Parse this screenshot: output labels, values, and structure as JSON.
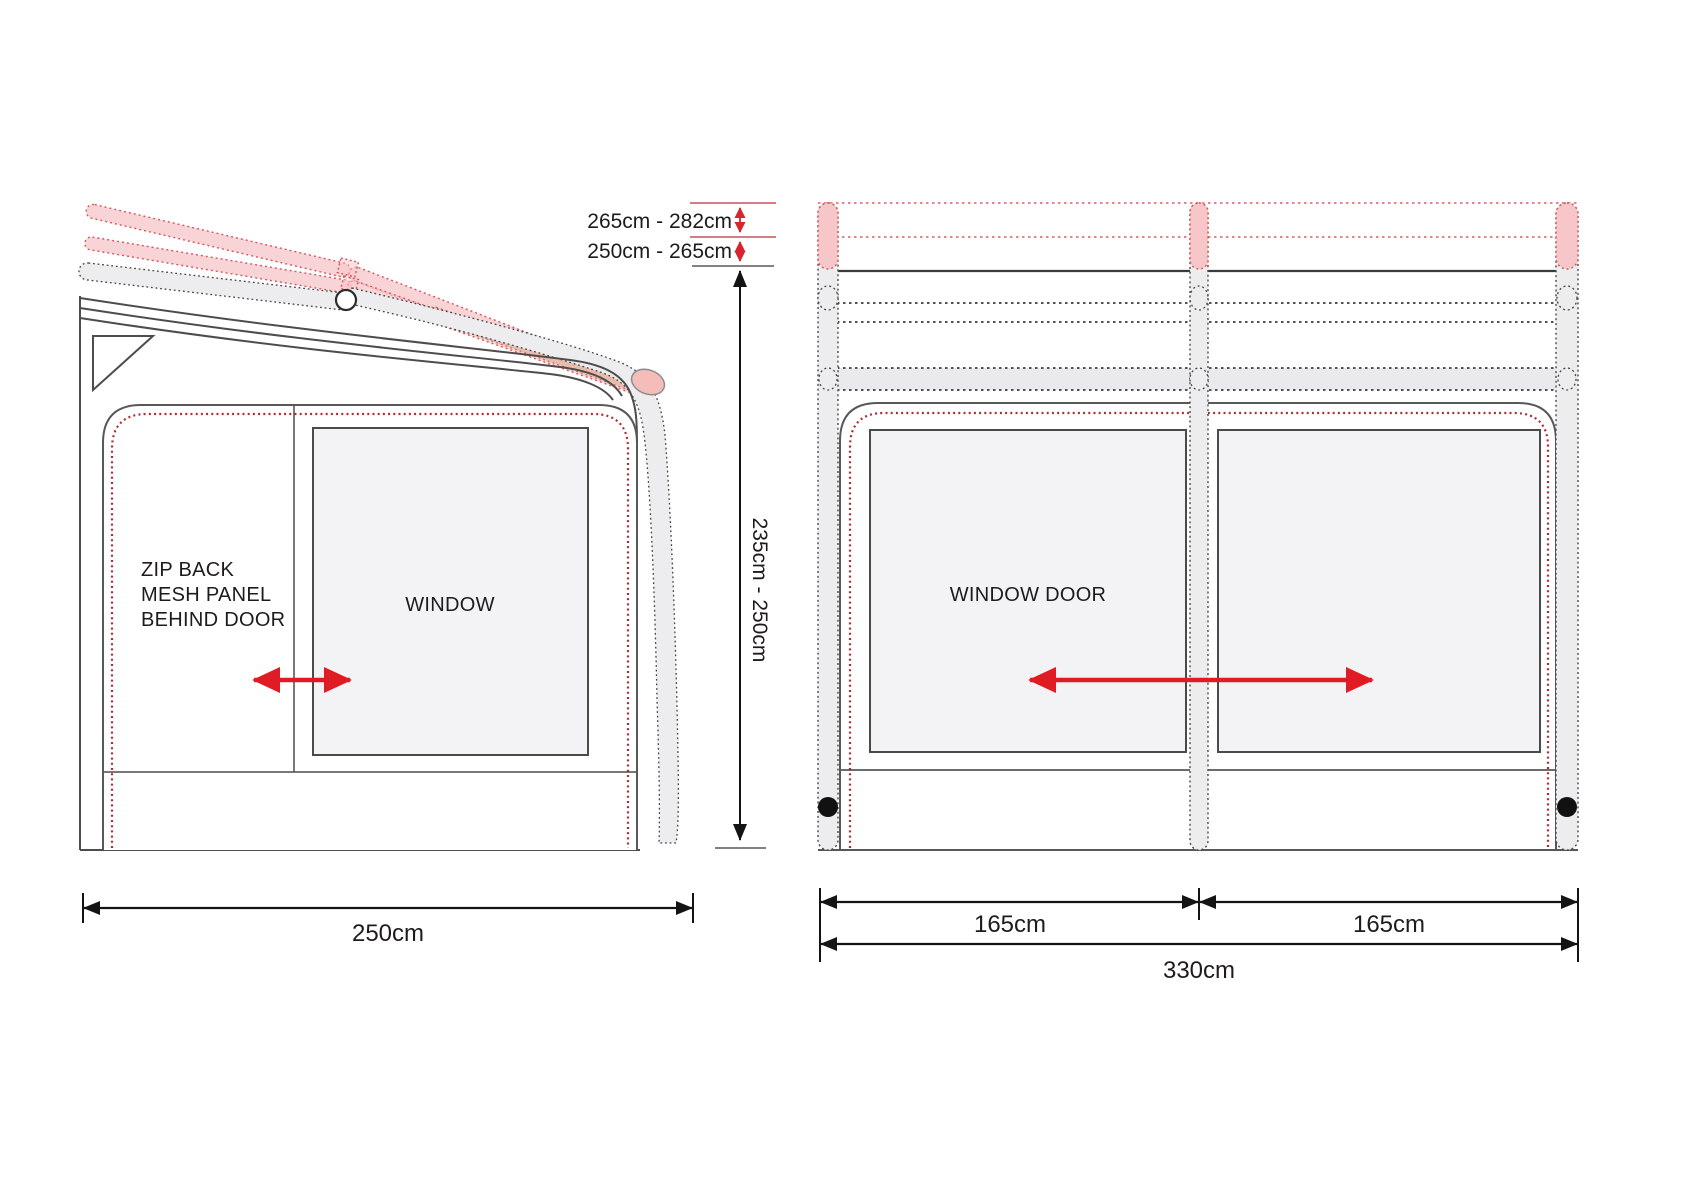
{
  "diagram": {
    "title_hint": "awning dimension diagram",
    "side_view": {
      "mesh_label_line1": "ZIP BACK",
      "mesh_label_line2": "MESH PANEL",
      "mesh_label_line3": "BEHIND DOOR",
      "window_label": "WINDOW",
      "width_dim": "250cm",
      "height_range_upper": "265cm - 282cm",
      "height_range_mid": "250cm - 265cm",
      "height_range_body": "235cm - 250cm"
    },
    "front_view": {
      "window_door_label": "WINDOW DOOR",
      "left_panel_dim": "165cm",
      "right_panel_dim": "165cm",
      "total_width_dim": "330cm"
    },
    "colors": {
      "accent_red": "#e01b24",
      "dim_red_line": "#c9505c",
      "trim_red": "#b02c31",
      "pole_pink_fill": "#f6c6c9",
      "pole_pink_stroke": "#d6565c",
      "pole_gray_fill": "#ededef",
      "window_fill": "#f3f3f5",
      "line_dark": "#414042"
    }
  }
}
